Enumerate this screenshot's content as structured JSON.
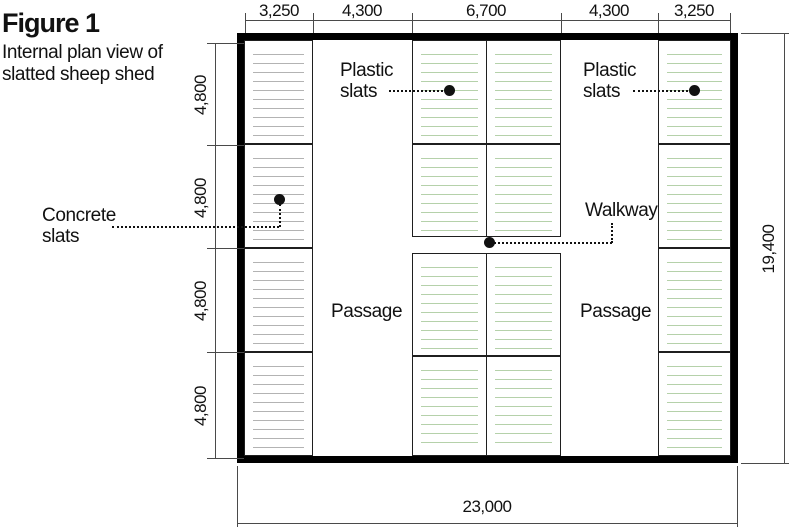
{
  "title": "Figure 1",
  "subtitle": "Internal plan view of slatted sheep shed",
  "labels": {
    "plastic_slats_left": "Plastic slats",
    "plastic_slats_right": "Plastic slats",
    "concrete_slats": "Concrete slats",
    "walkway": "Walkway",
    "passage_left": "Passage",
    "passage_right": "Passage"
  },
  "dimensions": {
    "top": [
      "3,250",
      "4,300",
      "6,700",
      "4,300",
      "3,250"
    ],
    "left": [
      "4,800",
      "4,800",
      "4,800",
      "4,800"
    ],
    "right_total": "19,400",
    "bottom_total": "23,000"
  },
  "colors": {
    "wall": "#000000",
    "panel_border": "#1f1f1f",
    "concrete_slat": "#b3b3b3",
    "plastic_slat": "#b5d1aa",
    "dimension_line": "#4a4a4a",
    "leader": "#111111",
    "text": "#111111",
    "background": "#ffffff"
  }
}
